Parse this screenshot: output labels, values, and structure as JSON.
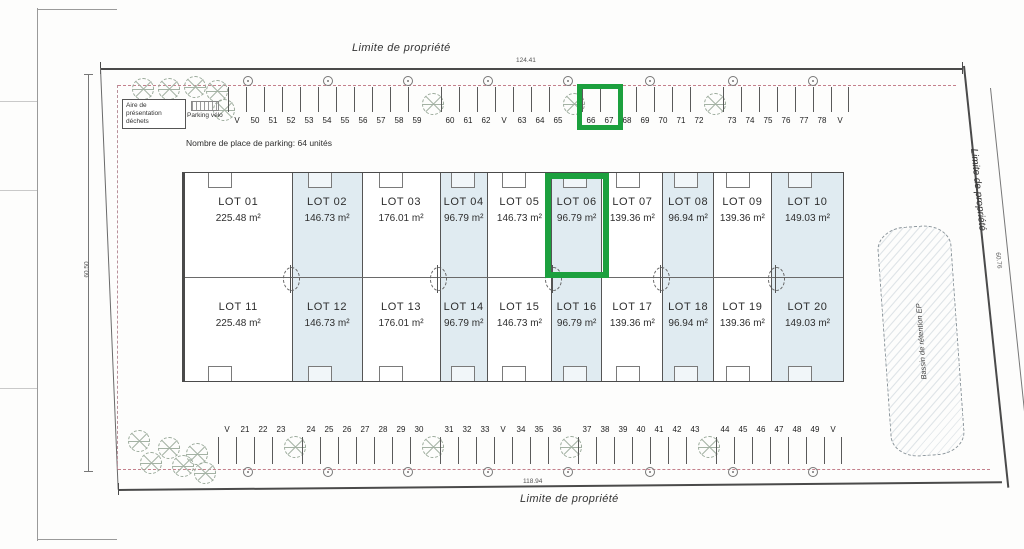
{
  "plan": {
    "boundary_label_top": "Limite de propriété",
    "boundary_label_bottom": "Limite de propriété",
    "boundary_label_right": "Limite de propriété",
    "dim_top": "124.41",
    "dim_bottom": "118.94",
    "dim_left": "60.50",
    "dim_right": "60.76",
    "parking_note": "Nombre de place de parking: 64 unités",
    "waste_area_label": "Aire de présentation déchets",
    "bike_parking_label": "Parking vélo",
    "basin_label": "Bassin de rétention EP",
    "highlight_color": "#1ca03e",
    "lot_shade_color": "#e0ebf1",
    "highlights": {
      "lot": "LOT 06",
      "parking_spaces": [
        "66",
        "67"
      ]
    }
  },
  "lots_row1": [
    {
      "name": "LOT 01",
      "area": "225.48 m²",
      "shaded": false,
      "flex": 108
    },
    {
      "name": "LOT 02",
      "area": "146.73 m²",
      "shaded": true,
      "flex": 70
    },
    {
      "name": "LOT 03",
      "area": "176.01 m²",
      "shaded": false,
      "flex": 78
    },
    {
      "name": "LOT 04",
      "area": "96.79 m²",
      "shaded": true,
      "flex": 47
    },
    {
      "name": "LOT 05",
      "area": "146.73 m²",
      "shaded": false,
      "flex": 64
    },
    {
      "name": "LOT 06",
      "area": "96.79 m²",
      "shaded": true,
      "flex": 50
    },
    {
      "name": "LOT 07",
      "area": "139.36 m²",
      "shaded": false,
      "flex": 61
    },
    {
      "name": "LOT 08",
      "area": "96.94 m²",
      "shaded": true,
      "flex": 50
    },
    {
      "name": "LOT 09",
      "area": "139.36 m²",
      "shaded": false,
      "flex": 58
    },
    {
      "name": "LOT 10",
      "area": "149.03 m²",
      "shaded": true,
      "flex": 72
    }
  ],
  "lots_row2": [
    {
      "name": "LOT 11",
      "area": "225.48 m²",
      "shaded": false,
      "flex": 108
    },
    {
      "name": "LOT 12",
      "area": "146.73 m²",
      "shaded": true,
      "flex": 70
    },
    {
      "name": "LOT 13",
      "area": "176.01 m²",
      "shaded": false,
      "flex": 78
    },
    {
      "name": "LOT 14",
      "area": "96.79 m²",
      "shaded": true,
      "flex": 47
    },
    {
      "name": "LOT 15",
      "area": "146.73 m²",
      "shaded": false,
      "flex": 64
    },
    {
      "name": "LOT 16",
      "area": "96.79 m²",
      "shaded": true,
      "flex": 50
    },
    {
      "name": "LOT 17",
      "area": "139.36 m²",
      "shaded": false,
      "flex": 61
    },
    {
      "name": "LOT 18",
      "area": "96.94 m²",
      "shaded": true,
      "flex": 50
    },
    {
      "name": "LOT 19",
      "area": "139.36 m²",
      "shaded": false,
      "flex": 58
    },
    {
      "name": "LOT 20",
      "area": "149.03 m²",
      "shaded": true,
      "flex": 72
    }
  ],
  "parking_top": [
    {
      "type": "velo",
      "label": "V"
    },
    {
      "type": "stall",
      "label": "50"
    },
    {
      "type": "stall",
      "label": "51"
    },
    {
      "type": "stall",
      "label": "52"
    },
    {
      "type": "stall",
      "label": "53"
    },
    {
      "type": "stall",
      "label": "54"
    },
    {
      "type": "stall",
      "label": "55"
    },
    {
      "type": "stall",
      "label": "56"
    },
    {
      "type": "stall",
      "label": "57"
    },
    {
      "type": "stall",
      "label": "58"
    },
    {
      "type": "stall",
      "label": "59"
    },
    {
      "type": "gap"
    },
    {
      "type": "stall",
      "label": "60"
    },
    {
      "type": "stall",
      "label": "61"
    },
    {
      "type": "stall",
      "label": "62"
    },
    {
      "type": "velo",
      "label": "V"
    },
    {
      "type": "stall",
      "label": "63"
    },
    {
      "type": "stall",
      "label": "64"
    },
    {
      "type": "stall",
      "label": "65"
    },
    {
      "type": "gap"
    },
    {
      "type": "stall",
      "label": "66",
      "highlighted": true
    },
    {
      "type": "stall",
      "label": "67",
      "highlighted": true
    },
    {
      "type": "stall",
      "label": "68"
    },
    {
      "type": "stall",
      "label": "69"
    },
    {
      "type": "stall",
      "label": "70"
    },
    {
      "type": "stall",
      "label": "71"
    },
    {
      "type": "stall",
      "label": "72"
    },
    {
      "type": "gap"
    },
    {
      "type": "stall",
      "label": "73"
    },
    {
      "type": "stall",
      "label": "74"
    },
    {
      "type": "stall",
      "label": "75"
    },
    {
      "type": "stall",
      "label": "76"
    },
    {
      "type": "stall",
      "label": "77"
    },
    {
      "type": "stall",
      "label": "78"
    },
    {
      "type": "velo",
      "label": "V"
    }
  ],
  "parking_bottom": [
    {
      "type": "velo",
      "label": "V"
    },
    {
      "type": "stall",
      "label": "21"
    },
    {
      "type": "stall",
      "label": "22"
    },
    {
      "type": "stall",
      "label": "23"
    },
    {
      "type": "gap"
    },
    {
      "type": "stall",
      "label": "24"
    },
    {
      "type": "stall",
      "label": "25"
    },
    {
      "type": "stall",
      "label": "26"
    },
    {
      "type": "stall",
      "label": "27"
    },
    {
      "type": "stall",
      "label": "28"
    },
    {
      "type": "stall",
      "label": "29"
    },
    {
      "type": "stall",
      "label": "30"
    },
    {
      "type": "gap"
    },
    {
      "type": "stall",
      "label": "31"
    },
    {
      "type": "stall",
      "label": "32"
    },
    {
      "type": "stall",
      "label": "33"
    },
    {
      "type": "velo",
      "label": "V"
    },
    {
      "type": "stall",
      "label": "34"
    },
    {
      "type": "stall",
      "label": "35"
    },
    {
      "type": "stall",
      "label": "36"
    },
    {
      "type": "gap"
    },
    {
      "type": "stall",
      "label": "37"
    },
    {
      "type": "stall",
      "label": "38"
    },
    {
      "type": "stall",
      "label": "39"
    },
    {
      "type": "stall",
      "label": "40"
    },
    {
      "type": "stall",
      "label": "41"
    },
    {
      "type": "stall",
      "label": "42"
    },
    {
      "type": "stall",
      "label": "43"
    },
    {
      "type": "gap"
    },
    {
      "type": "stall",
      "label": "44"
    },
    {
      "type": "stall",
      "label": "45"
    },
    {
      "type": "stall",
      "label": "46"
    },
    {
      "type": "stall",
      "label": "47"
    },
    {
      "type": "stall",
      "label": "48"
    },
    {
      "type": "stall",
      "label": "49"
    },
    {
      "type": "velo",
      "label": "V"
    }
  ]
}
